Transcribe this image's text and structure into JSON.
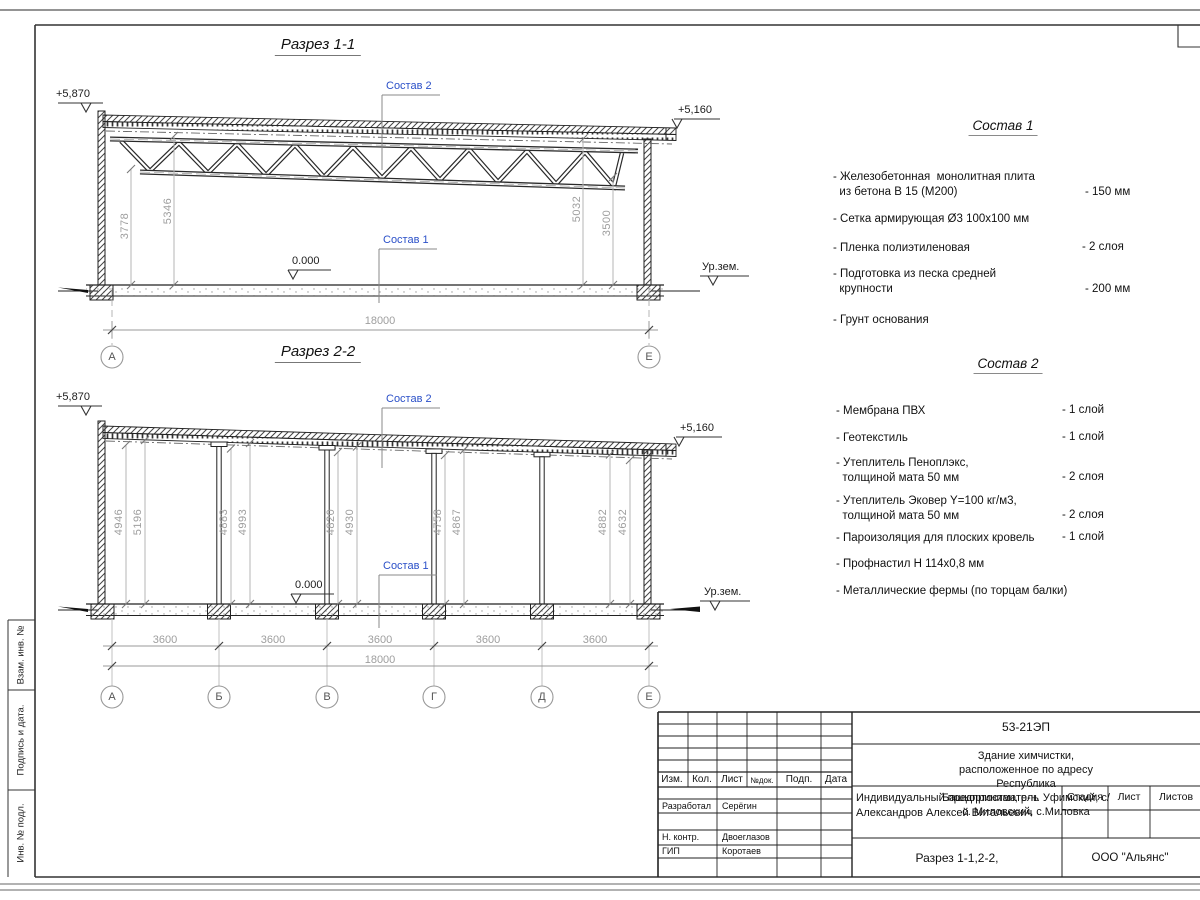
{
  "section1": {
    "title": "Разрез 1-1",
    "composition2_label": "Состав 2",
    "composition1_label": "Состав 1",
    "level_top_left": "+5,870",
    "level_top_right": "+5,160",
    "level_zero": "0.000",
    "ground_level_label": "Ур.зем.",
    "dim_left_inner": "3778",
    "dim_left_outer": "5346",
    "dim_right_outer": "5032",
    "dim_right_inner": "3500",
    "dim_total": "18000",
    "axis_left": "А",
    "axis_right": "Е"
  },
  "section2": {
    "title": "Разрез 2-2",
    "composition2_label": "Состав 2",
    "composition1_label": "Состав 1",
    "level_top_left": "+5,870",
    "level_top_right": "+5,160",
    "level_zero": "0.000",
    "ground_level_label": "Ур.зем.",
    "height_dims": [
      "4946",
      "5196",
      "4883",
      "4993",
      "4820",
      "4930",
      "4758",
      "4867",
      "4882",
      "4632"
    ],
    "bay_dims": [
      "3600",
      "3600",
      "3600",
      "3600",
      "3600"
    ],
    "dim_total": "18000",
    "axes": [
      "А",
      "Б",
      "В",
      "Г",
      "Д",
      "Е"
    ]
  },
  "composition1": {
    "title": "Состав 1",
    "items": [
      {
        "text": "- Железобетонная  монолитная плита\n  из бетона В 15 (М200)",
        "value": "- 150 мм"
      },
      {
        "text": "- Сетка армирующая Ø3 100x100 мм",
        "value": ""
      },
      {
        "text": "- Пленка полиэтиленовая",
        "value": "-  2 слоя"
      },
      {
        "text": "- Подготовка из песка средней\n  крупности",
        "value": "- 200 мм"
      },
      {
        "text": "- Грунт основания",
        "value": ""
      }
    ]
  },
  "composition2": {
    "title": "Состав 2",
    "items": [
      {
        "text": "- Мембрана ПВХ",
        "value": "- 1 слой"
      },
      {
        "text": "- Геотекстиль",
        "value": "- 1 слой"
      },
      {
        "text": "- Утеплитель Пеноплэкс,\n  толщиной мата 50 мм",
        "value": "- 2 слоя"
      },
      {
        "text": "- Утеплитель Эковер Y=100 кг/м3,\n  толщиной мата 50 мм",
        "value": "- 2 слоя"
      },
      {
        "text": "- Пароизоляция для плоских кровель",
        "value": "- 1 слой"
      },
      {
        "text": "- Профнастил Н 114х0,8 мм",
        "value": ""
      },
      {
        "text": "- Металлические фермы (по торцам балки)",
        "value": ""
      }
    ]
  },
  "titleblock": {
    "doc_code": "53-21ЭП",
    "project_description": "Здание химчистки,  расположенное по адресу Республика\nБашкортостан, р-н. Уфимский, с/с. Миловский, с.Миловка",
    "client": "Индивидуальный предприниматель\nАлександров Алексей Витальевич",
    "sheet_title": "Разрез 1-1,2-2,",
    "organization": "ООО \"Альянс\"",
    "col_izm": "Изм.",
    "col_kol": "Кол.",
    "col_list": "Лист",
    "col_ndoc": "№док.",
    "col_podp": "Подп.",
    "col_data": "Дата",
    "stage_label": "Стадия",
    "sheet_label": "Лист",
    "sheets_label": "Листов",
    "roles": [
      {
        "role": "Разработал",
        "name": "Серёгин"
      },
      {
        "role": "Н. контр.",
        "name": "Двоеглазов"
      },
      {
        "role": "ГИП",
        "name": "Коротаев"
      }
    ]
  },
  "side_strip": {
    "cells": [
      "Взам. инв. №",
      "Подпись и дата.",
      "Инв. № подл."
    ]
  },
  "colors": {
    "annotation_blue": "#2b50c8",
    "dim_gray": "#9e9e9e",
    "line_black": "#1a1a1a"
  }
}
